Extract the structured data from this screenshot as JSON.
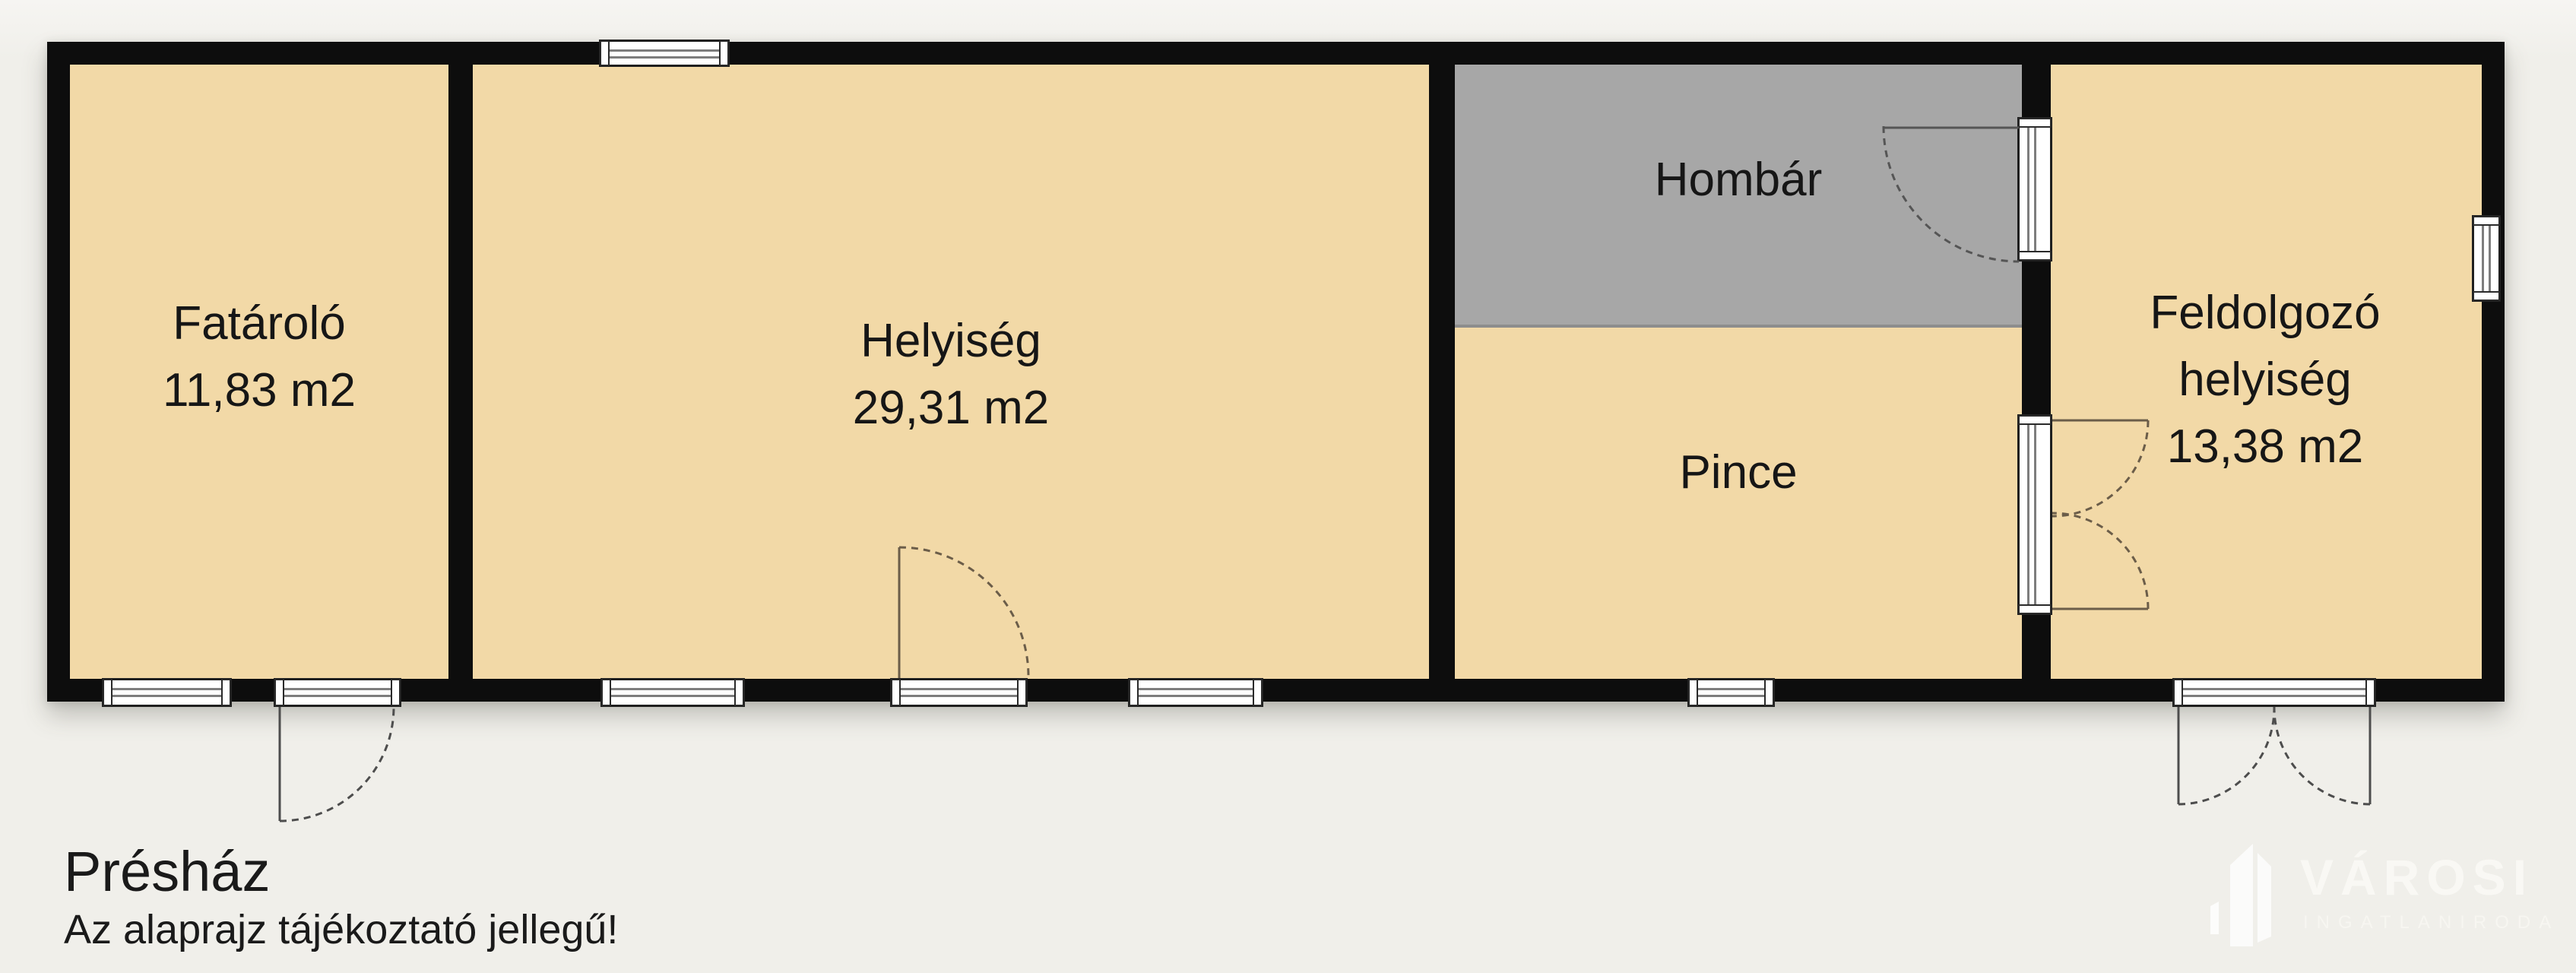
{
  "page": {
    "background": "#f0efea"
  },
  "plan": {
    "building_name": "Présház",
    "disclaimer": "Az alaprajz tájékoztató jellegű!",
    "colors": {
      "wall": "#0d0d0d",
      "room_fill": "#f2d9a7",
      "hombar_fill": "#a7a7a7",
      "door_swing_interior": "#6b5d49",
      "door_swing_exterior": "#4d4d4d"
    },
    "rooms": [
      {
        "id": "fatarolo",
        "lines": [
          "Fatároló",
          "11,83 m2"
        ]
      },
      {
        "id": "helyiseg",
        "lines": [
          "Helyiség",
          "29,31 m2"
        ]
      },
      {
        "id": "hombar",
        "lines": [
          "Hombár"
        ]
      },
      {
        "id": "pince",
        "lines": [
          "Pince"
        ]
      },
      {
        "id": "feldolgozo-helyiseg",
        "lines": [
          "Feldolgozó",
          "helyiség",
          "13,38 m2"
        ]
      }
    ]
  },
  "watermark": {
    "brand": "VÁROSI",
    "tagline": "INGATLANIRODA",
    "color": "#f9f8f4"
  }
}
